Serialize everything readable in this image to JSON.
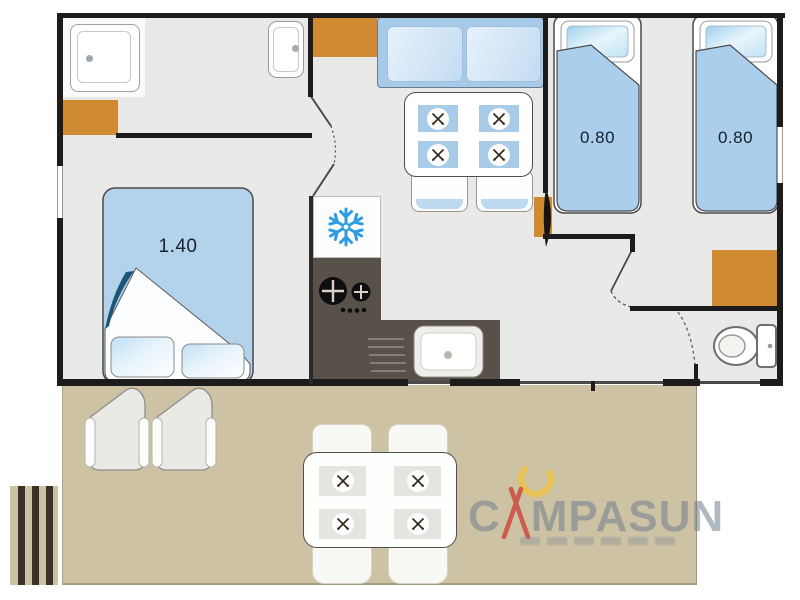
{
  "floorplan": {
    "labels": {
      "master_bed_size": "1.40",
      "twin_bed_1_size": "0.80",
      "twin_bed_2_size": "0.80"
    }
  },
  "logo": {
    "brand": "CAMPASUN",
    "brand_c": "C",
    "brand_rest": "MPASUN"
  },
  "palette": {
    "wall": "#1c1c1c",
    "floor": "#e9e9e7",
    "terrace": "#cec2a4",
    "cabinet_orange": "#d08a31",
    "furniture_blue": "#abceec",
    "cushion_blue": "#cfe4f4",
    "counter_dark": "#57514a",
    "snowflake_blue": "#2d9ce0",
    "navy_fold": "#1d5478",
    "logo_gray": "#8e9ca6",
    "logo_red": "#cb4a40",
    "logo_yellow": "#edc243"
  },
  "icons": {
    "fridge": "snowflake-icon",
    "placemats": "crossed-cutlery-icon",
    "stove": "burner-icon",
    "toilet": "toilet-icon",
    "shower": "shower-tray-icon"
  }
}
